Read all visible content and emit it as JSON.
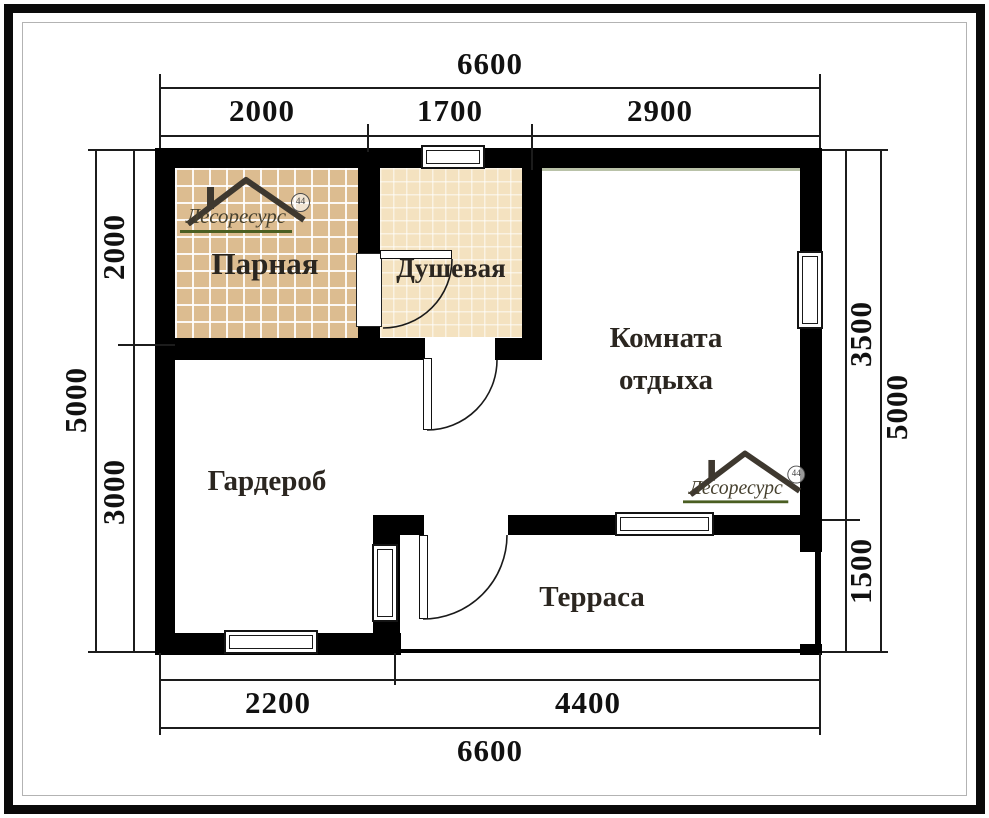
{
  "dimensions": {
    "top": {
      "total": "6600",
      "seg1": "2000",
      "seg2": "1700",
      "seg3": "2900"
    },
    "bottom": {
      "total": "6600",
      "seg1": "2200",
      "seg2": "4400"
    },
    "left": {
      "total": "5000",
      "seg1": "2000",
      "seg2": "3000"
    },
    "right": {
      "total": "5000",
      "seg1": "3500",
      "seg2": "1500"
    }
  },
  "rooms": {
    "parnaya": "Парная",
    "dushevaya": "Душевая",
    "komnata_line1": "Комната",
    "komnata_line2": "отдыха",
    "garderob": "Гардероб",
    "terrasa": "Терраса"
  },
  "logo": {
    "text": "Лесоресурс",
    "badge": "44"
  },
  "colors": {
    "wall": "#000000",
    "tile_parnaya": "#dcbc90",
    "tile_dushevaya": "#f4e2c0",
    "logo_green": "#4a5e22",
    "logo_ink": "#3e382f"
  }
}
